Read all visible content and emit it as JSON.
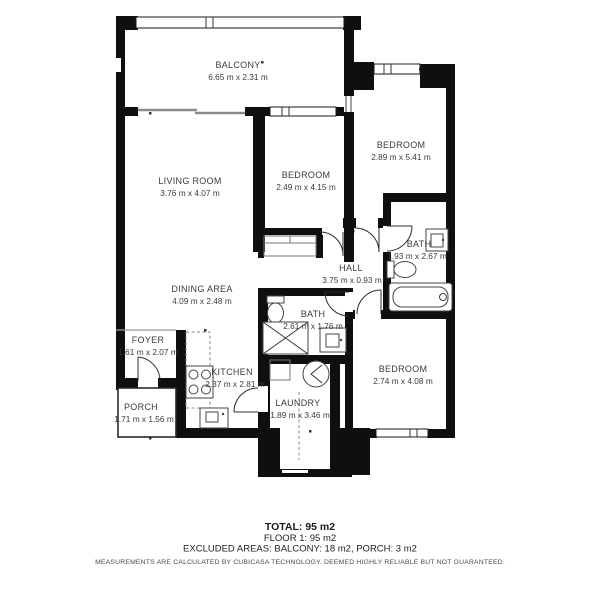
{
  "rooms": {
    "balcony": {
      "name": "BALCONY",
      "dims": "6.65 m x 2.31 m"
    },
    "living_room": {
      "name": "LIVING ROOM",
      "dims": "3.76 m x 4.07 m"
    },
    "bedroom_mid": {
      "name": "BEDROOM",
      "dims": "2.49 m x 4.15 m"
    },
    "bedroom_right": {
      "name": "BEDROOM",
      "dims": "2.89 m x 5.41 m"
    },
    "bath_right": {
      "name": "BATH",
      "dims": "1.93 m x 2.67 m"
    },
    "hall": {
      "name": "HALL",
      "dims": "3.75 m x 0.93 m"
    },
    "dining": {
      "name": "DINING AREA",
      "dims": "4.09 m x 2.48 m"
    },
    "bath_center": {
      "name": "BATH",
      "dims": "2.61 m x 1.76 m"
    },
    "foyer": {
      "name": "FOYER",
      "dims": "1.61 m x 2.07 m"
    },
    "kitchen": {
      "name": "KITCHEN",
      "dims": "2.37 m x 2.81 m"
    },
    "porch": {
      "name": "PORCH",
      "dims": "1.71 m x 1.56 m"
    },
    "laundry": {
      "name": "LAUNDRY",
      "dims": "1.89 m x 3.46 m"
    },
    "bedroom_bottom": {
      "name": "BEDROOM",
      "dims": "2.74 m x 4.08 m"
    }
  },
  "summary": {
    "total": "TOTAL: 95 m2",
    "floor": "FLOOR 1: 95 m2",
    "excluded": "EXCLUDED AREAS: BALCONY: 18 m2, PORCH: 3 m2",
    "disclaimer": "MEASUREMENTS ARE CALCULATED BY CUBICASA TECHNOLOGY. DEEMED HIGHLY RELIABLE BUT NOT GUARANTEED."
  },
  "colors": {
    "wall": "#0f0f0f",
    "label_text": "#3b3b3b",
    "background": "#ffffff"
  }
}
